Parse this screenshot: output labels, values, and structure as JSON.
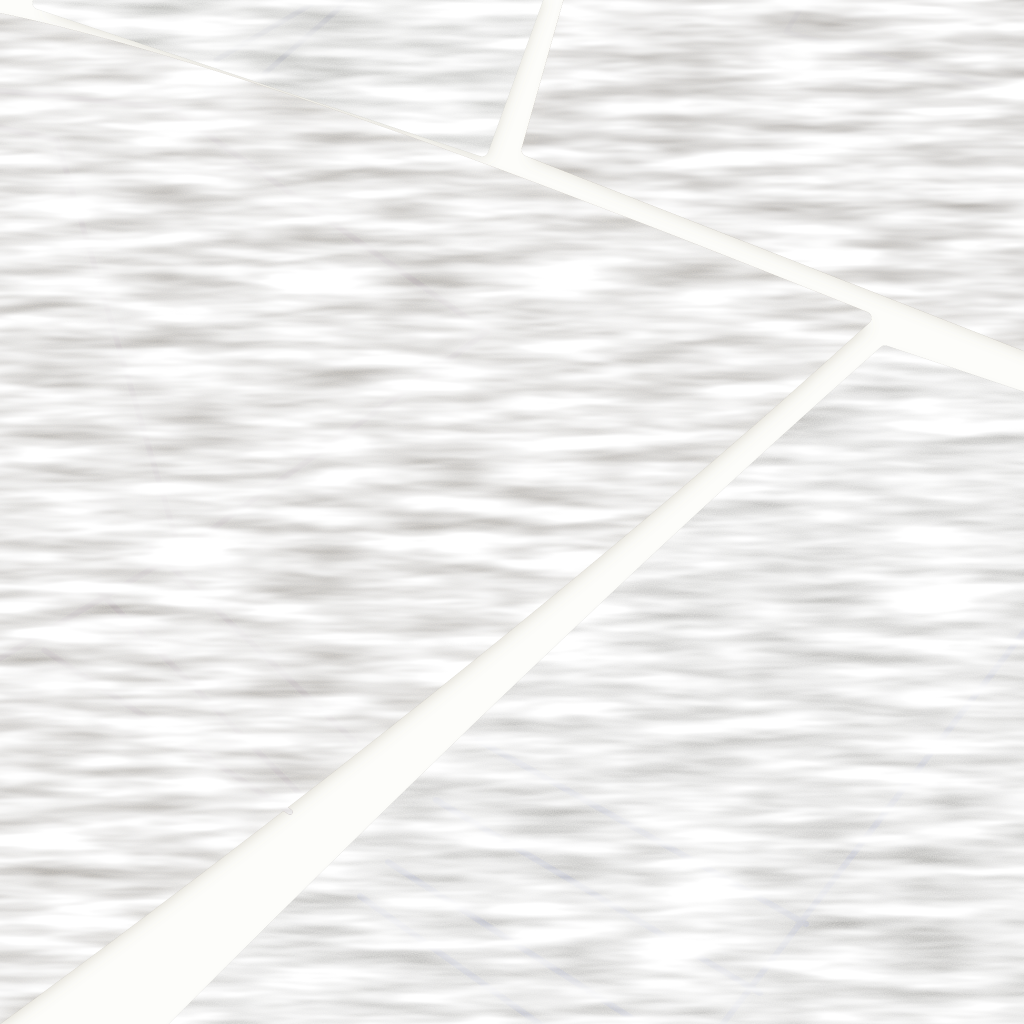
{
  "meta": {
    "description": "Overhead photograph of four modern hand-loomed rugs arranged diagonally on a white floor: a large taupe rug with thin burgundy geometric border lines, a khaki-brown rug with a dark red corner line, a pale sage rug with two navy stripes, and a light grey rug with cobalt blue parallel lines meeting a perpendicular border line.",
    "canvas": {
      "width": 1024,
      "height": 1024
    },
    "floor_color": "#fdfdfa",
    "shadow_color": "rgba(140,128,104,0.30)"
  },
  "rugs": [
    {
      "id": "rug-top-left",
      "label": "pale sage rug with navy stripes",
      "fill": "#c6c8b8",
      "edge": "#d6d8ca",
      "shape": {
        "type": "polygon",
        "points": [
          [
            39,
            3
          ],
          [
            540,
            -10
          ],
          [
            482,
            150
          ]
        ]
      },
      "lines": {
        "color": "#475585",
        "width": 5,
        "paths": [
          [
            [
              322,
              -2
            ],
            [
              216,
              60
            ]
          ],
          [
            [
              351,
              -2
            ],
            [
              264,
              74
            ]
          ]
        ]
      }
    },
    {
      "id": "rug-top-right",
      "label": "khaki brown rug with dark red corner line",
      "fill": "#967d52",
      "edge": "#a68d60",
      "shape": {
        "type": "polygon",
        "points": [
          [
            573,
            -10
          ],
          [
            1034,
            -10
          ],
          [
            1034,
            348
          ],
          [
            528,
            150
          ]
        ]
      },
      "lines": {
        "color": "#5f1517",
        "width": 5,
        "paths": [
          [
            [
              808,
              -4
            ],
            [
              786,
              32
            ],
            [
              1034,
              98
            ]
          ]
        ]
      }
    },
    {
      "id": "rug-main",
      "label": "large taupe rug with burgundy geometric lines",
      "fill": "#b4a283",
      "edge": "#c4b392",
      "shape": {
        "type": "path",
        "d": "M -8,18 C 200,60 500,172 865,318 Q 500,650 -8,1022 Z"
      },
      "lines": {
        "color": "#7e1630",
        "width": 5.5,
        "paths": [
          [
            [
              -6,
              90
            ],
            [
              170,
              108
            ],
            [
              487,
              332
            ],
            [
              180,
              552
            ],
            [
              -6,
              662
            ]
          ],
          [
            [
              -6,
              126
            ],
            [
              57,
              140
            ],
            [
              180,
              552
            ]
          ],
          [
            [
              150,
              546
            ],
            [
              355,
              742
            ]
          ],
          [
            [
              96,
              588
            ],
            [
              300,
              794
            ]
          ],
          [
            [
              44,
              650
            ],
            [
              290,
              812
            ]
          ]
        ]
      }
    },
    {
      "id": "rug-bottom-right",
      "label": "light grey rug with cobalt blue lines",
      "fill": "#d0cdc0",
      "edge": "#dedbce",
      "shape": {
        "type": "path",
        "d": "M 885,352 L 1034,402 L 1034,1034 L 168,1034 Q 560,640 885,352 Z"
      },
      "lines": {
        "color": "#5b73c4",
        "width": 6,
        "paths": [
          [
            [
              1030,
              624
            ],
            [
              718,
              1030
            ]
          ],
          [
            [
              478,
              740
            ],
            [
              806,
              924
            ]
          ],
          [
            [
              436,
              800
            ],
            [
              760,
              993
            ]
          ],
          [
            [
              388,
              862
            ],
            [
              650,
              1030
            ]
          ],
          [
            [
              360,
              896
            ],
            [
              548,
              1030
            ]
          ]
        ]
      }
    }
  ]
}
